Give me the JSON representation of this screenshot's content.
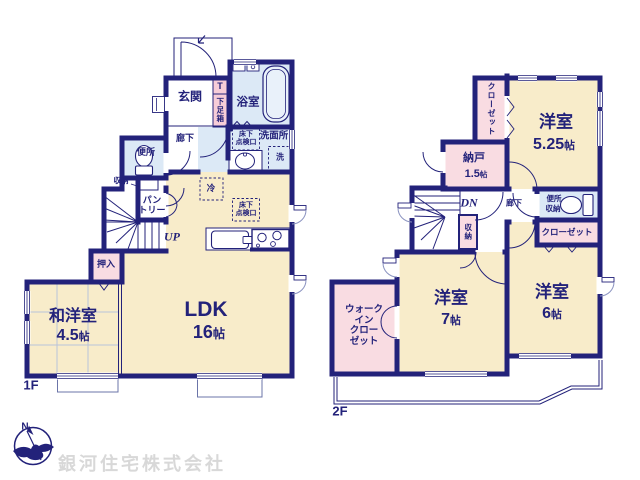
{
  "company_watermark": "銀河住宅株式会社",
  "compass": {
    "north_label": "N"
  },
  "floor1": {
    "floor_label": "1F",
    "entrance": "玄関",
    "shoe_t": "T",
    "shoe_box": "下足箱",
    "bathroom": "浴室",
    "washroom": "洗面所",
    "washer": "洗",
    "underfloor_hatch_lines": [
      "床下",
      "点検口"
    ],
    "hallway": "廊下",
    "toilet": "便所",
    "storage": "収納",
    "pantry_lines": [
      "パン",
      "トリー"
    ],
    "fridge": "冷",
    "stairs": "UP",
    "closet_oshiire": "押入",
    "japanese_room": {
      "name": "和洋室",
      "size_num": "4.5",
      "size_unit": "帖"
    },
    "ldk": {
      "name": "LDK",
      "size_num": "16",
      "size_unit": "帖"
    }
  },
  "floor2": {
    "floor_label": "2F",
    "closet_north": "クローゼット",
    "bedroom_525": {
      "name": "洋室",
      "size_num": "5.25",
      "size_unit": "帖"
    },
    "storeroom": {
      "name": "納戸",
      "size_num": "1.5",
      "size_unit": "帖"
    },
    "stairs": "DN",
    "hallway": "廊下",
    "toilet": "便所",
    "toilet_storage": "収納",
    "stair_storage": "収納",
    "closet_east": "クローゼット",
    "walkin_closet_lines": [
      "ウォーク",
      "イン",
      "クロー",
      "ゼット"
    ],
    "bedroom_7": {
      "name": "洋室",
      "size_num": "7",
      "size_unit": "帖"
    },
    "bedroom_6": {
      "name": "洋室",
      "size_num": "6",
      "size_unit": "帖"
    }
  },
  "colors": {
    "wall": "#23227a",
    "room_cream": "#f8ecca",
    "room_blue": "#dce9f6",
    "room_pink": "#f9dce2",
    "accent_pink": "#f7cdd8",
    "text": "#23227a",
    "watermark": "#d8d8d8"
  }
}
